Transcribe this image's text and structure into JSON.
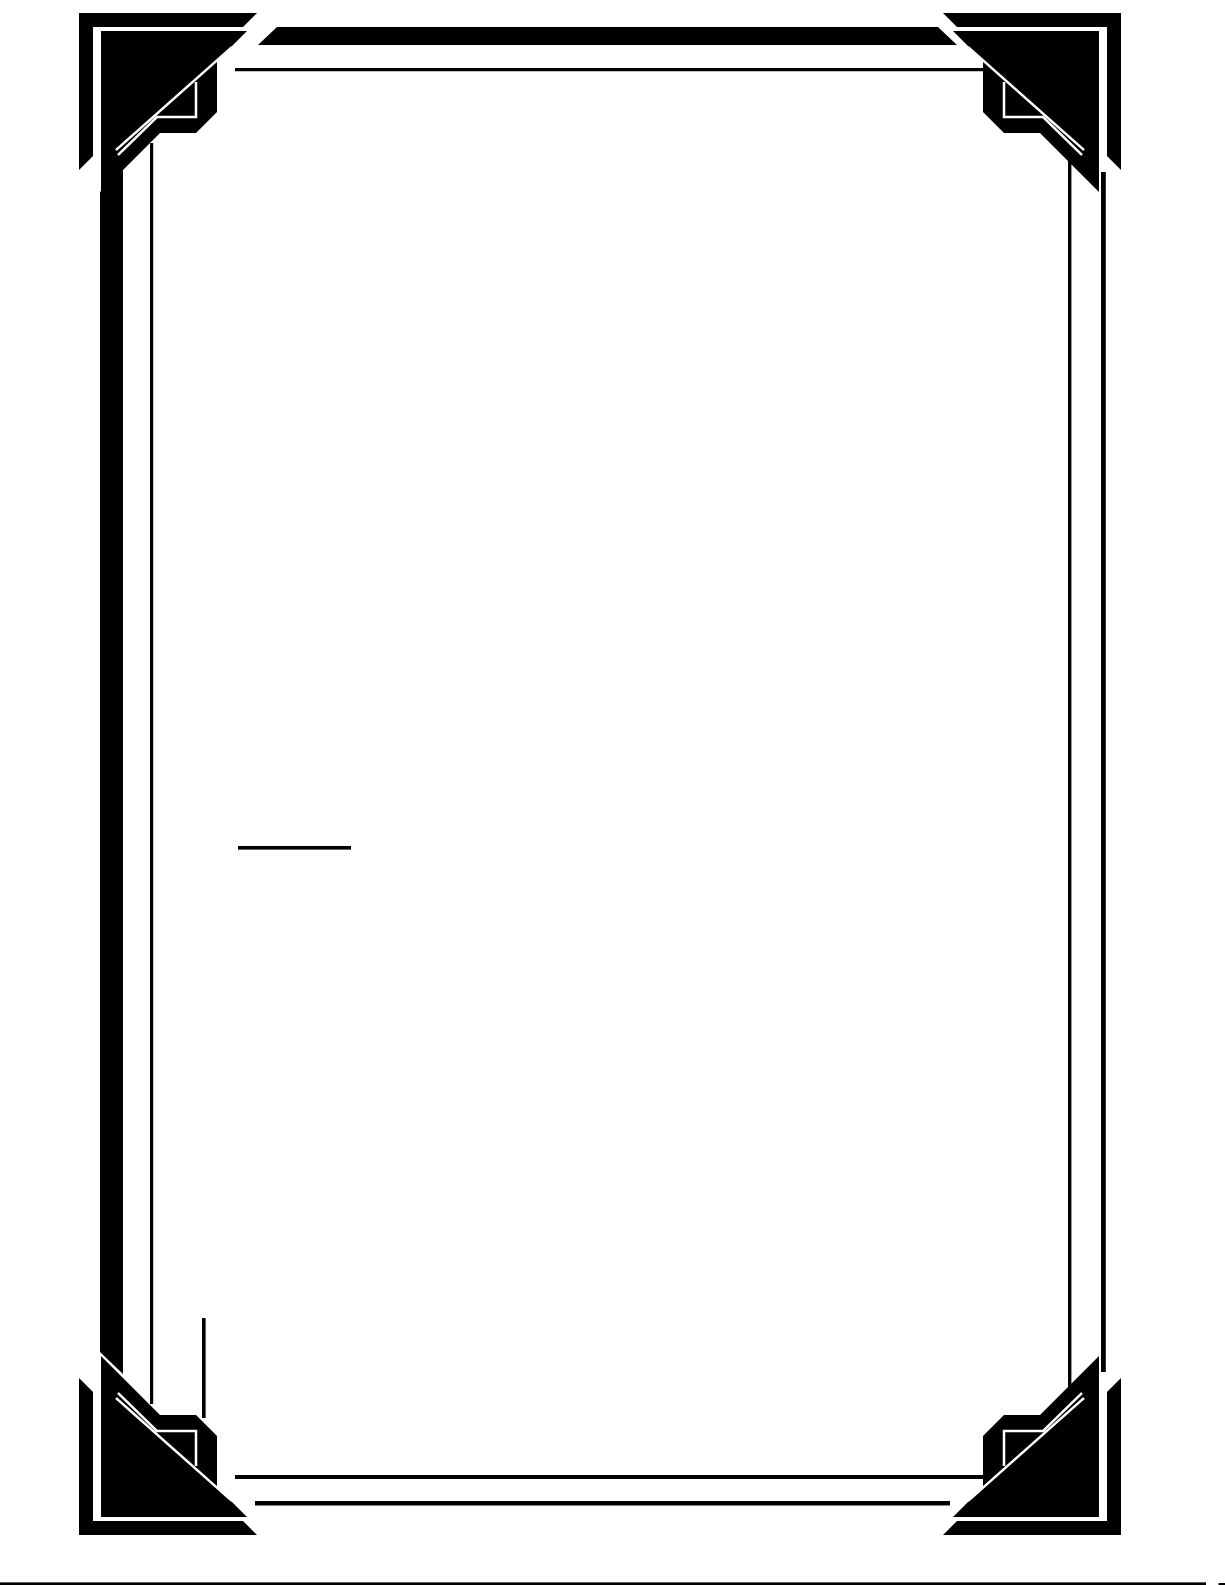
{
  "canvas": {
    "width": 1225,
    "height": 1585
  },
  "colors": {
    "bg": "#ffffff",
    "ink": "#000000"
  },
  "page": {
    "kind": "blank ornamental bordered page",
    "text_content": ""
  },
  "frame": {
    "corner_paths": [
      {
        "name": "corner-echo-bracket",
        "d": "M 79 13 H 257 L 243 27 H 93 V 156 L 79 170 Z",
        "fill": "ink"
      },
      {
        "name": "corner-main-mass",
        "d": "M 101 31 H 247 L 217 61 V 112 L 196 133 H 160 L 101 192 Z",
        "fill": "ink"
      },
      {
        "name": "corner-diagonal-hairline",
        "d": "M 232 47 L 116 150",
        "stroke": "bg",
        "width": 2.5
      },
      {
        "name": "corner-staircase-hairline",
        "d": "M 196 82 V 117 H 157 L 118 155",
        "stroke": "bg",
        "width": 2.5
      }
    ],
    "corners": [
      {
        "position": "top-left",
        "transform": ""
      },
      {
        "position": "top-right",
        "transform": "translate(1200,0) scale(-1,1)"
      },
      {
        "position": "bottom-left",
        "transform": "translate(0,1548) scale(1,-1)"
      },
      {
        "position": "bottom-right",
        "transform": "translate(1200,1548) scale(-1,-1)"
      }
    ],
    "edges": [
      {
        "name": "top-outer-bar",
        "d": "M 277 27 H 938 L 957 45 H 258 Z",
        "fill": "ink"
      },
      {
        "name": "top-inner-rule",
        "d": "M 235 68 H 988 V 71.2 H 235 Z",
        "fill": "ink"
      },
      {
        "name": "left-outer-bar",
        "d": "M 100 192 L 123 170 V 1374 L 100 1352 Z",
        "fill": "ink"
      },
      {
        "name": "left-inner-rule",
        "d": "M 150 143 H 153.2 V 1404 H 150 Z",
        "fill": "ink"
      },
      {
        "name": "right-inner-rule",
        "d": "M 1068 150 H 1071.4 V 1396 H 1068 Z",
        "fill": "ink"
      },
      {
        "name": "right-outer-rule",
        "d": "M 1101 172 H 1105.8 V 1372 H 1101 Z",
        "fill": "ink"
      },
      {
        "name": "bottom-inner-rule",
        "d": "M 235 1475 H 988 V 1479 H 235 Z",
        "fill": "ink"
      },
      {
        "name": "bottom-outer-rule",
        "d": "M 255 1501 H 950 V 1505.5 H 255 Z",
        "fill": "ink"
      },
      {
        "name": "bottom-left-corner-stub-rule",
        "d": "M 202 1318 H 205.6 V 1418 H 202 Z",
        "fill": "ink"
      }
    ]
  },
  "marks": [
    {
      "name": "short-horizontal-rule",
      "d": "M 238 846 H 351 V 849.6 H 238 Z",
      "fill": "ink"
    },
    {
      "name": "page-bottom-scan-line",
      "d": "M 0 1582.4 H 1206 V 1585 H 0 Z",
      "fill": "ink"
    },
    {
      "name": "page-bottom-scan-tick",
      "d": "M 1218.5 1583 H 1225 V 1585 H 1218.5 Z",
      "fill": "ink"
    }
  ]
}
